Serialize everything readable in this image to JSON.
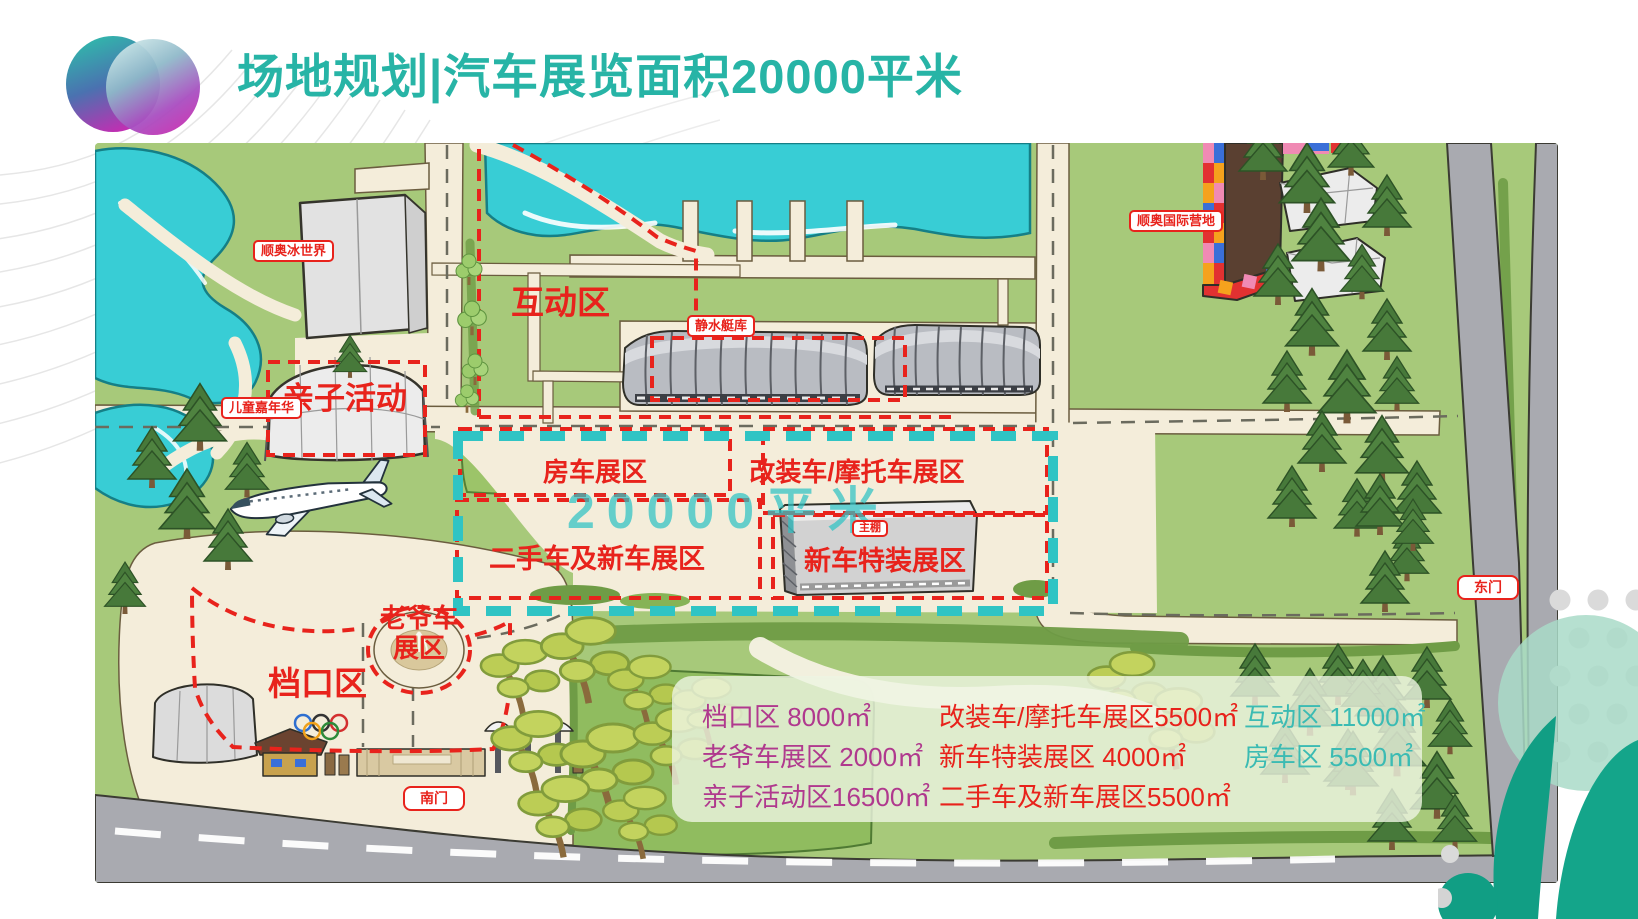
{
  "header": {
    "title": "场地规划|汽车展览面积20000平米"
  },
  "map": {
    "watermark": "20000平米",
    "zones": {
      "interactive": "互动区",
      "parent_child": "亲子活动",
      "rv": "房车展区",
      "modified_moto": "改装车/摩托车展区",
      "used_new": "二手车及新车展区",
      "new_special": "新车特装展区",
      "classic_1": "老爷车",
      "classic_2": "展区",
      "stall": "档口区"
    },
    "badges": {
      "ice_world": "顺奥冰世界",
      "kids_carnival": "儿童嘉年华",
      "boathouse": "静水艇库",
      "intl_camp": "顺奥国际营地",
      "main_shed": "主棚",
      "south_gate": "南门",
      "east_gate": "东门"
    }
  },
  "legend": {
    "col1": {
      "color": "#b0398e",
      "items": [
        "档口区 8000㎡",
        "老爷车展区 2000㎡",
        "亲子活动区16500㎡"
      ]
    },
    "col2": {
      "color": "#e8221b",
      "items": [
        "改装车/摩托车展区5500㎡",
        "新车特装展区 4000㎡",
        "二手车及新车展区5500㎡"
      ]
    },
    "col3": {
      "color": "#3bbbb3",
      "items": [
        "互动区 11000㎡",
        "房车区 5500㎡"
      ]
    }
  },
  "colors": {
    "title": "#27b4a6",
    "zone_label": "#e8231c",
    "watermark": "#2fc3c5",
    "outline_teal": "#2fc4c4"
  }
}
